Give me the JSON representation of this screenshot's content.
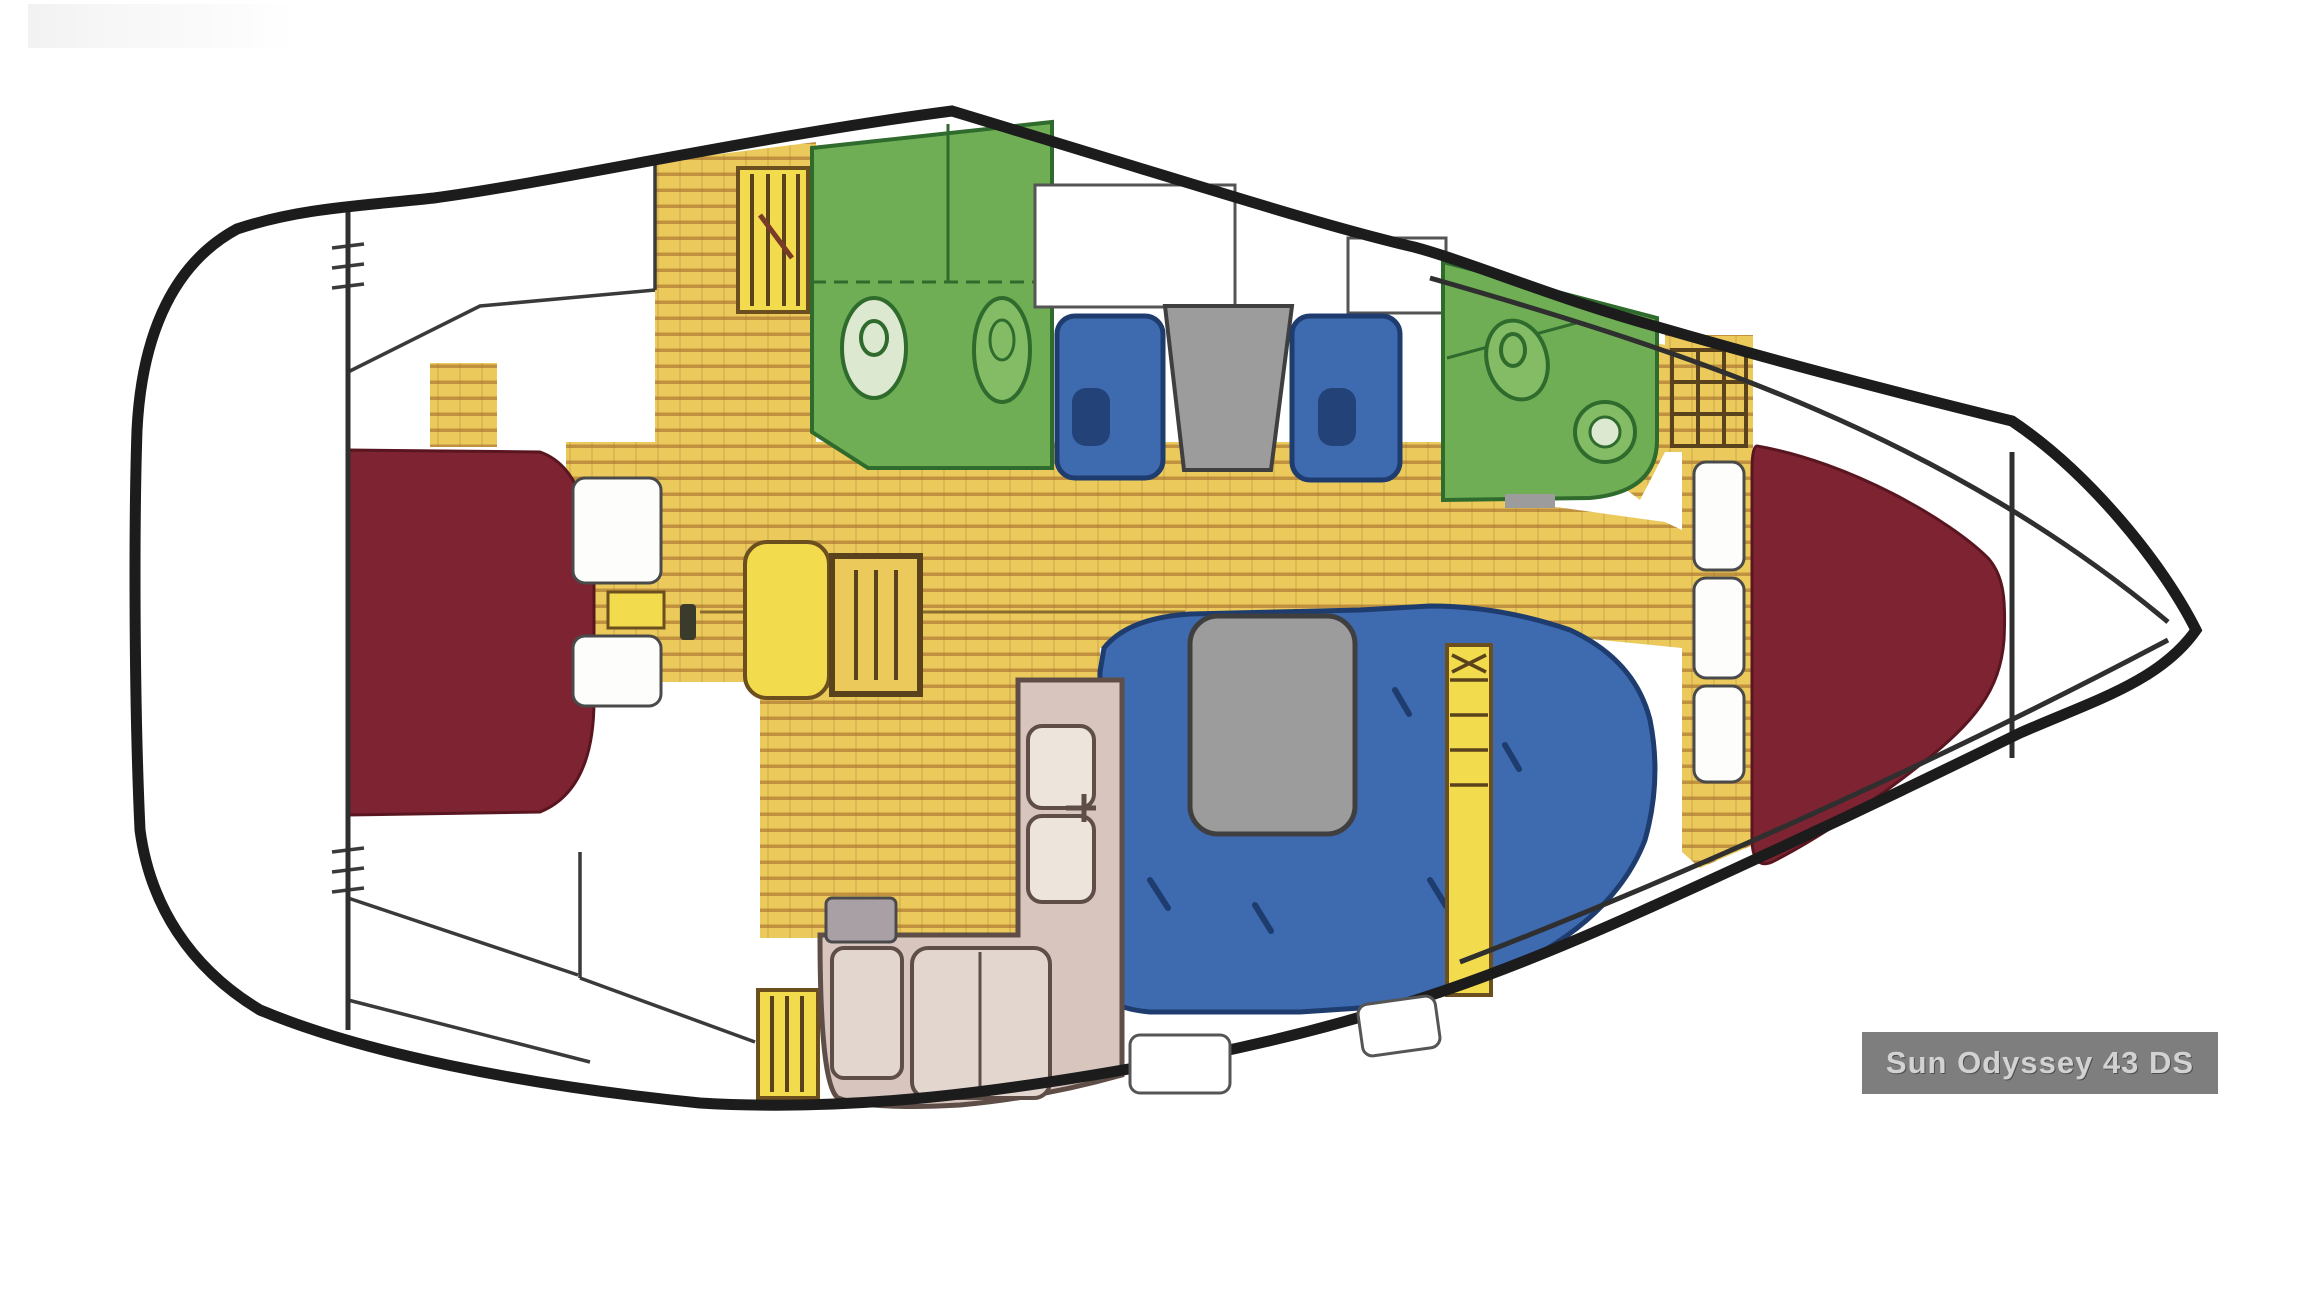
{
  "badge": {
    "text": "Sun Odyssey 43 DS",
    "bg": "#7E7E7E",
    "fg": "#D2D2D2"
  },
  "colors": {
    "hull_line": "#1C1C1C",
    "wall_line": "#2F2F2F",
    "thin_line": "#3A3A3A",
    "floor_base": "#ECC95B",
    "floor_stripe": "#B9893A",
    "floor_joint": "#8A6C2F",
    "floor_accent": "#F2DC4E",
    "wood_dark": "#6B4F1E",
    "wood_frame": "#5A431C",
    "head_green": "#6FAE55",
    "head_green_light": "#84BC66",
    "head_green_pale": "#DDE8D0",
    "head_green_dark": "#2F6B2C",
    "seat_blue": "#3E6AB0",
    "seat_blue_dark": "#1E3C6E",
    "table_gray": "#9C9C9C",
    "table_gray_dark": "#3F3F3F",
    "berth_red": "#7E2331",
    "berth_red_dark": "#5A1620",
    "galley_tan": "#D8C5BD",
    "galley_tan_light": "#EDE4DC",
    "galley_fixture": "#E2D6CE",
    "galley_outline": "#5E4E47",
    "locker_white": "#FDFDFB",
    "locker_outline": "#4A4A4A",
    "metal_gray": "#A9A0A6",
    "mast_dark": "#3B3B2B",
    "bench_outline": "#555555"
  }
}
